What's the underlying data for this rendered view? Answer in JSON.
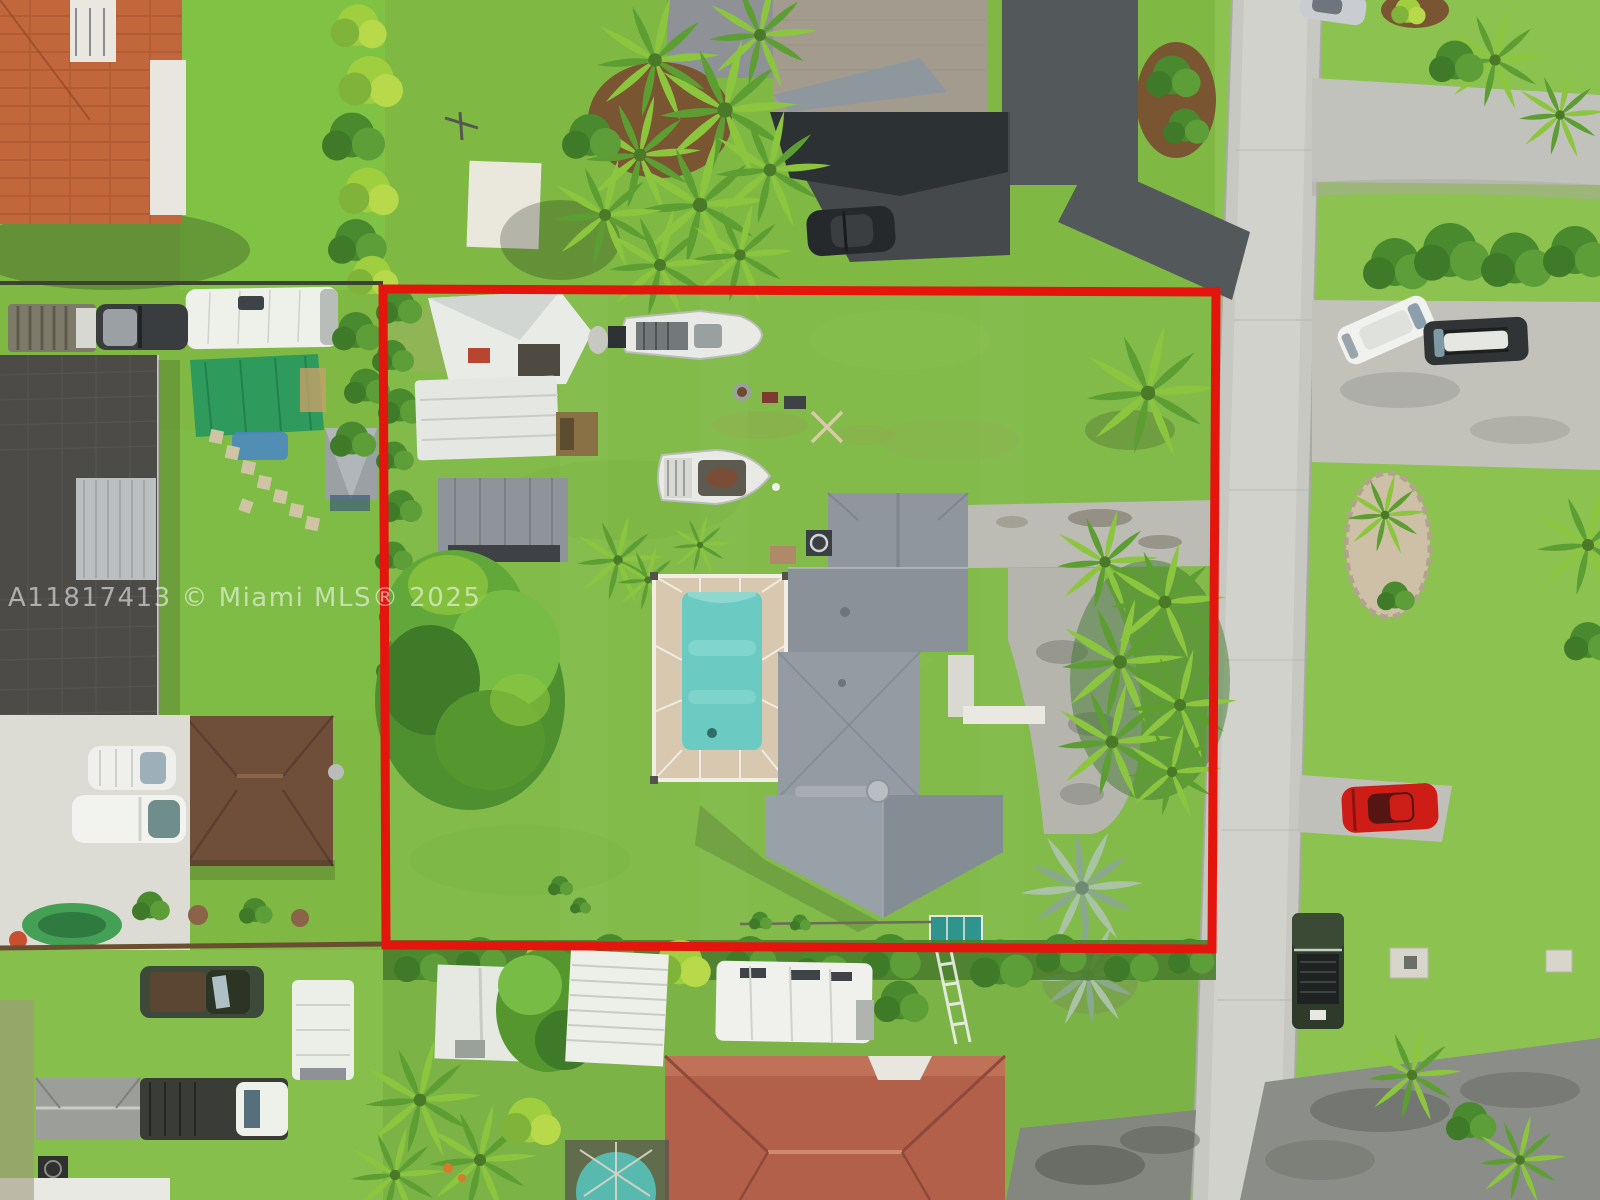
{
  "watermark": {
    "text": "A11817413 © Miami MLS® 2025"
  },
  "boundary": {
    "color": "#e3150d",
    "stroke_width": 9
  },
  "colors": {
    "lawn_base": "#7fb944",
    "lot_lawn": "#82bb4a",
    "street": "#c8c8c2",
    "pool_water": "#6bcac2",
    "pool_deck": "#d8c8b0",
    "main_roof": "#8f969d",
    "orange_tile_roof": "#c2673c",
    "dark_roof": "#4c4b47",
    "brown_roof": "#6f4e3a",
    "bottom_house_roof": "#b2604a",
    "green_canopy": "#2e9a5c",
    "teal_shed": "#2f958c",
    "red_car": "#ce1d17",
    "boundary_red": "#e3150d"
  }
}
